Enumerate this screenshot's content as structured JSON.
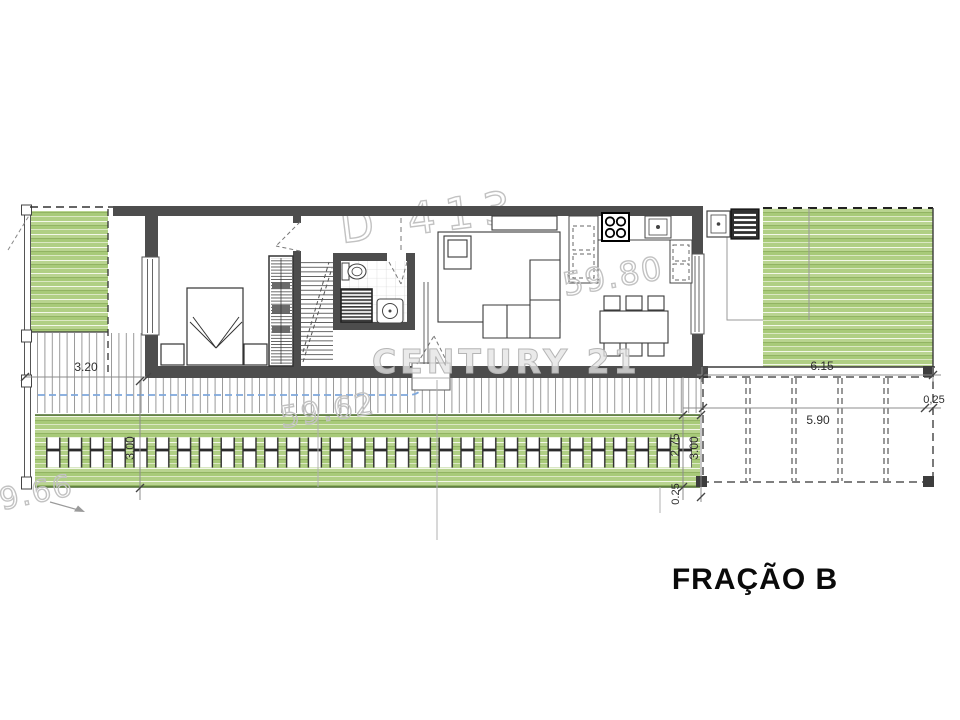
{
  "plan": {
    "unit_label": "FRAÇÃO B",
    "dimensions": {
      "terrace_width": "3.20",
      "terrace_depth": "3.00",
      "right_garden_width": "6.15",
      "right_edge": "0,25",
      "carport_width": "5.90",
      "planter_depth": "2.75",
      "outdoor_depth": "3.00",
      "planter_edge": "0.25"
    },
    "watermarks": {
      "plot_code": "D 413",
      "area_interior": "59.80",
      "brand": "CENTURY 21",
      "area_exterior": "59.62",
      "plot_length": "9.66"
    },
    "colors": {
      "wall": "#4d4d4d",
      "grass_light": "#b9d490",
      "grass_dark": "#8aad5a",
      "pool_line": "#7fa8dc",
      "watermark": "#c2c2c2"
    }
  }
}
